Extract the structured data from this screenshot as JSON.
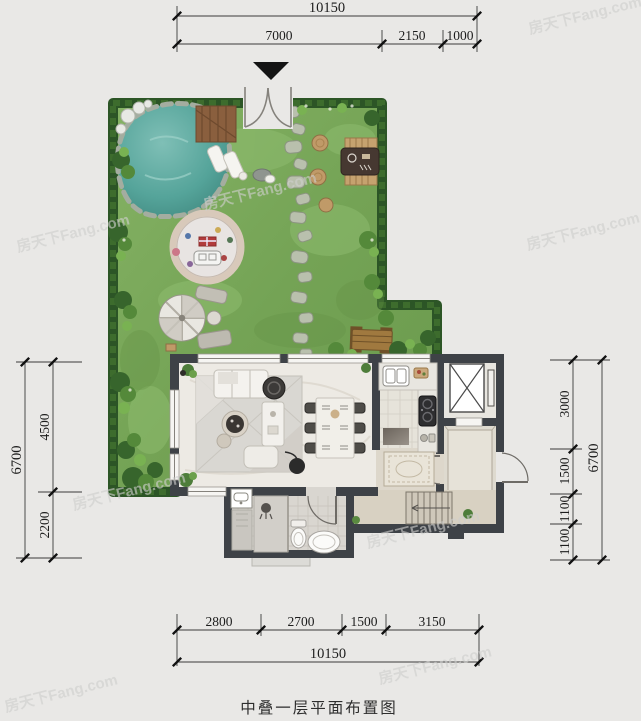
{
  "caption": "中叠一层平面布置图",
  "watermark": {
    "text": "房天下Fang.com"
  },
  "dims": {
    "top_total": "10150",
    "top_segments": [
      "7000",
      "2150",
      "1000"
    ],
    "bottom_segments": [
      "2800",
      "2700",
      "1500",
      "3150"
    ],
    "bottom_total": "10150",
    "left_total": "6700",
    "left_segments": [
      "4500",
      "2200"
    ],
    "right_segments": [
      "3000",
      "1500",
      "1100",
      "1100"
    ],
    "right_total": "6700"
  },
  "colors": {
    "background": "#e9e8e6",
    "grass": "#7cab5c",
    "hedge": "#2f5b27",
    "pond": "#55a49a",
    "wall": "#3e4247",
    "floor_marble": "#edeae4",
    "wood": "#a0793f",
    "dim_line": "#1c1c1c"
  },
  "icons": {
    "entry_arrow": "entrance direction marker"
  }
}
